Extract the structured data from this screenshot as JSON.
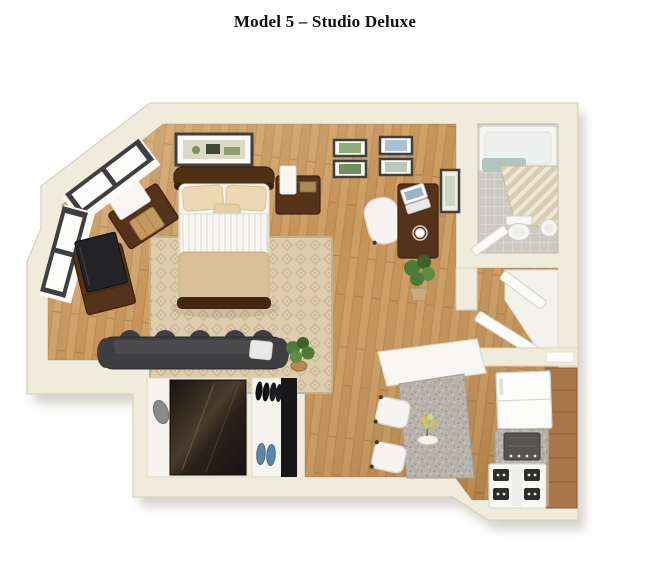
{
  "title": "Model 5 – Studio Deluxe",
  "palette": {
    "background": "#ffffff",
    "title_text": "#111111",
    "wall_fill": "#efecdc",
    "wall_edge": "#d6d1bb",
    "wood_light": "#cd9d62",
    "wood_mid": "#c49257",
    "wood_dark": "#aa7a43",
    "rug_base": "#ddcdac",
    "rug_pattern": "#c7b28a",
    "tile_base": "#cbc9c2",
    "tile_grout": "#e3e1db",
    "granite": "#b7b3aa",
    "fixture_white": "#f7f6f2",
    "dark_wood": "#55331a",
    "charcoal": "#3e3e40",
    "bed_tan": "#d9bf98",
    "plant_green": "#4c7a38",
    "water_teal": "#a9c0bb",
    "shoe_blue": "#5d86ab",
    "frame_dark": "#3f3f3d"
  },
  "floor_plan": {
    "model": "Model 5",
    "unit_type": "Studio Deluxe",
    "view": "3D isometric cutaway floor plan",
    "rooms": [
      {
        "name": "Living / Sleeping Area",
        "floor": "hardwood",
        "furniture": [
          "double bed with tan throw",
          "patterned area rug",
          "left nightstand with lamp and basket",
          "right nightstand with lamp",
          "dresser with flat tv",
          "charcoal sofa",
          "desk with laptop and coffee cup",
          "white desk chair",
          "potted plants",
          "framed wall art (1 large, 4 small)",
          "two window groups"
        ]
      },
      {
        "name": "Bathroom",
        "floor": "mosaic tile",
        "furniture": [
          "bathtub",
          "glass slat screen",
          "toilet",
          "round sink",
          "inward swinging door",
          "framed picture on outer wall"
        ]
      },
      {
        "name": "Hall Closet",
        "floor": "white",
        "furniture": [
          "two open white doors"
        ]
      },
      {
        "name": "Walk-in Closet",
        "floor": "white",
        "furniture": [
          "dark mirrored panel",
          "grey floor mat"
        ]
      },
      {
        "name": "Shoe Closet",
        "floor": "white",
        "furniture": [
          "black shelf",
          "two pairs black shoes",
          "pair blue slippers"
        ]
      },
      {
        "name": "Kitchen",
        "floor": "hardwood",
        "furniture": [
          "white refrigerator",
          "granite counter with dark cooktop",
          "white range with four burners",
          "brown cabinet run",
          "granite breakfast-bar island with white counter header",
          "two white stools",
          "vase of yellow flowers"
        ]
      }
    ]
  }
}
